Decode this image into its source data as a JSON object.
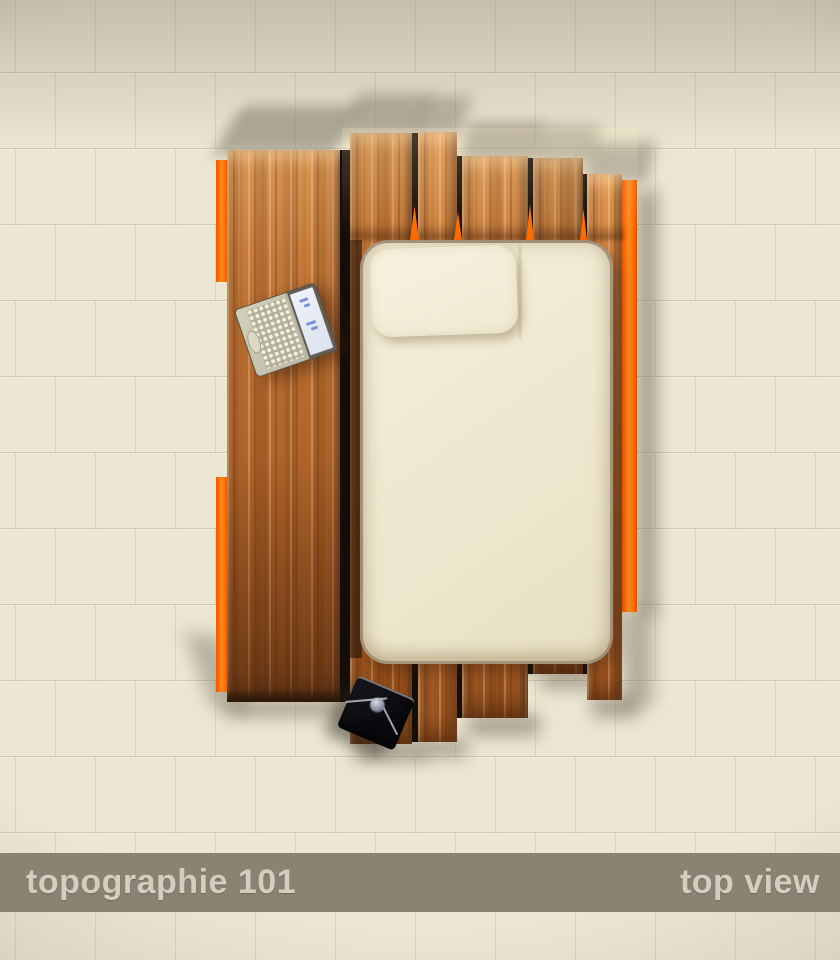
{
  "footer": {
    "left_label": "topographie 101",
    "right_label": "top view"
  },
  "scene": {
    "objects": [
      {
        "name": "desk-panel",
        "material": "wood"
      },
      {
        "name": "headboard-slats",
        "material": "wood",
        "count": 5
      },
      {
        "name": "orange-edge-trim",
        "segments": 3
      },
      {
        "name": "bed-mattress"
      },
      {
        "name": "pillow"
      },
      {
        "name": "laptop-open"
      },
      {
        "name": "envelope-bag"
      }
    ]
  },
  "colors": {
    "background": "#ece7d2",
    "accent_orange": "#ff6a00",
    "wood_base": "#b06a32",
    "mattress": "#efe8d3",
    "footer_band": "#837e6c",
    "footer_text": "#d2cfc2",
    "bag_black": "#0b0b0f"
  }
}
